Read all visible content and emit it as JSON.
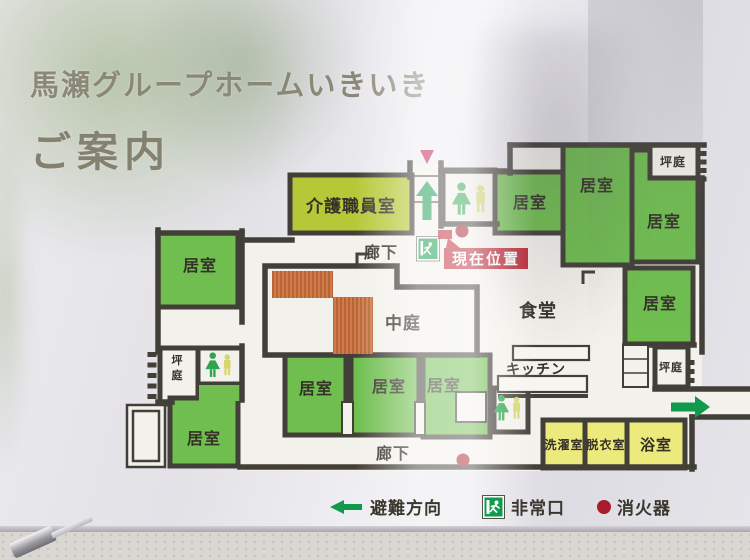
{
  "sign": {
    "title_line1": "馬瀬グループホームいきいき",
    "title_line2": "ご案内"
  },
  "current_location": {
    "label": "現在位置"
  },
  "legend": {
    "evacuation": "避難方向",
    "emergency_exit": "非常口",
    "extinguisher": "消火器"
  },
  "colors": {
    "room_green": "#6fbe4f",
    "staff_lime": "#b6c838",
    "bath_yellow": "#ece97d",
    "wall": "#423e38",
    "deck_orange": "#d07c4a",
    "deck_stripe": "#ad5a2e",
    "badge_red": "#bd2433",
    "dot_red": "#a91a2c",
    "arrow_green": "#119a4e",
    "entry_triangle": "#c21f53",
    "floor": "#f3f1eb",
    "label_ink": "#353129",
    "toilet_female": "#2ea44c",
    "toilet_male": "#d5d66e"
  },
  "floorplan": {
    "rooms": [
      {
        "label": "介護職員室",
        "x": 290,
        "y": 175,
        "w": 122,
        "h": 58,
        "fill": "lime",
        "fs": 17,
        "lx": 351,
        "ly": 212
      },
      {
        "label": "",
        "x": 443,
        "y": 170,
        "w": 52,
        "h": 54,
        "fill": "white"
      },
      {
        "label": "居室",
        "x": 495,
        "y": 172,
        "w": 68,
        "h": 61,
        "fill": "green",
        "fs": 16,
        "lx": 530,
        "ly": 208
      },
      {
        "label": "居室",
        "x": 563,
        "y": 145,
        "w": 69,
        "h": 120,
        "fill": "green",
        "fs": 16,
        "lx": 597,
        "ly": 191
      },
      {
        "label": "居室",
        "x": 632,
        "y": 150,
        "w": 66,
        "h": 112,
        "fill": "green",
        "fs": 16,
        "lx": 664,
        "ly": 227
      },
      {
        "label": "坪庭",
        "x": 650,
        "y": 145,
        "w": 48,
        "h": 33,
        "fill": "white",
        "fs": 12,
        "lx": 673,
        "ly": 166
      },
      {
        "label": "居室",
        "x": 625,
        "y": 268,
        "w": 68,
        "h": 76,
        "fill": "green",
        "fs": 16,
        "lx": 660,
        "ly": 309
      },
      {
        "label": "坪庭",
        "x": 655,
        "y": 347,
        "w": 33,
        "h": 40,
        "fill": "white",
        "fs": 11,
        "lx": 671,
        "ly": 371
      },
      {
        "label": "居室",
        "x": 158,
        "y": 233,
        "w": 80,
        "h": 74,
        "fill": "green",
        "fs": 16,
        "lx": 200,
        "ly": 271
      },
      {
        "label": "坪庭",
        "x": 160,
        "y": 348,
        "w": 38,
        "h": 56,
        "fill": "white",
        "fs": 11,
        "vertical": true,
        "lx": 177,
        "ly": 364
      },
      {
        "label": "",
        "x": 198,
        "y": 348,
        "w": 44,
        "h": 36,
        "fill": "white"
      },
      {
        "label": "居室",
        "x": 170,
        "y": 398,
        "w": 68,
        "h": 68,
        "fill": "green",
        "fs": 16,
        "lx": 204,
        "ly": 444
      },
      {
        "label": "居室",
        "x": 285,
        "y": 355,
        "w": 61,
        "h": 80,
        "fill": "green",
        "fs": 16,
        "lx": 316,
        "ly": 394
      },
      {
        "label": "居室",
        "x": 351,
        "y": 355,
        "w": 68,
        "h": 80,
        "fill": "green",
        "fs": 16,
        "lx": 389,
        "ly": 392
      },
      {
        "label": "居室",
        "x": 423,
        "y": 355,
        "w": 67,
        "h": 82,
        "fill": "green",
        "fs": 16,
        "lx": 444,
        "ly": 391
      },
      {
        "label": "",
        "x": 494,
        "y": 388,
        "w": 34,
        "h": 44,
        "fill": "white"
      },
      {
        "label": "洗濯室",
        "x": 543,
        "y": 420,
        "w": 42,
        "h": 48,
        "fill": "yellow",
        "fs": 12,
        "lx": 564,
        "ly": 449
      },
      {
        "label": "脱衣室",
        "x": 585,
        "y": 420,
        "w": 42,
        "h": 48,
        "fill": "yellow",
        "fs": 12,
        "lx": 606,
        "ly": 449
      },
      {
        "label": "浴室",
        "x": 627,
        "y": 420,
        "w": 58,
        "h": 48,
        "fill": "yellow",
        "fs": 15,
        "lx": 656,
        "ly": 450
      }
    ],
    "green_tab": {
      "x": 199,
      "y": 385,
      "w": 42,
      "h": 16
    },
    "labels": [
      {
        "text": "廊下",
        "x": 381,
        "y": 258,
        "fs": 16
      },
      {
        "text": "廊下",
        "x": 393,
        "y": 459,
        "fs": 16
      },
      {
        "text": "中庭",
        "x": 403,
        "y": 329,
        "fs": 17
      },
      {
        "text": "食堂",
        "x": 538,
        "y": 317,
        "fs": 18
      },
      {
        "text": "キッチン",
        "x": 536,
        "y": 374,
        "fs": 14
      }
    ],
    "hatch_decks": [
      {
        "x": 272,
        "y": 271,
        "w": 61,
        "h": 27
      },
      {
        "x": 333,
        "y": 297,
        "w": 40,
        "h": 57
      }
    ],
    "open_edges": [
      {
        "x": 697.5,
        "y": 151,
        "n": 4,
        "step": 8.5
      },
      {
        "x": 147.5,
        "y": 352,
        "n": 5,
        "step": 10.5
      },
      {
        "x": 685.5,
        "y": 360,
        "n": 3,
        "step": 9
      }
    ],
    "counters": [
      {
        "x": 513,
        "y": 346,
        "w": 76,
        "h": 14
      },
      {
        "x": 498,
        "y": 376,
        "w": 89,
        "h": 16
      }
    ],
    "closet": {
      "x": 623,
      "y": 345,
      "w": 25,
      "h": 42
    },
    "notches": [
      {
        "x": 342,
        "y": 402,
        "w": 11,
        "h": 33
      },
      {
        "x": 415,
        "y": 402,
        "w": 10,
        "h": 33
      },
      {
        "x": 456,
        "y": 392,
        "w": 30,
        "h": 30
      }
    ],
    "porch": [
      {
        "x": 127,
        "y": 405,
        "w": 38,
        "h": 62
      },
      {
        "x": 133,
        "y": 411,
        "w": 26,
        "h": 50
      }
    ],
    "toilets": [
      {
        "cx": 471,
        "cy": 199,
        "h": 34
      },
      {
        "cx": 220,
        "cy": 365,
        "h": 26
      },
      {
        "cx": 509,
        "cy": 408,
        "h": 27
      }
    ],
    "exit_sign": {
      "x": 418,
      "y": 238,
      "s": 20
    },
    "arrows": [
      {
        "tailx": 427,
        "taily": 220,
        "dir": "up",
        "len": 39
      },
      {
        "tailx": 671,
        "taily": 407,
        "dir": "right",
        "len": 39
      }
    ],
    "extinguishers": [
      {
        "x": 462,
        "y": 231
      },
      {
        "x": 463,
        "y": 460
      }
    ],
    "entry_triangle": {
      "x": 427,
      "y": 150,
      "w": 14,
      "h": 14
    },
    "badge": {
      "x": 444,
      "y": 248,
      "w": 84,
      "h": 21,
      "fs": 15
    },
    "tick": {
      "x": 438,
      "y": 230,
      "w": 14,
      "h": 9
    }
  }
}
